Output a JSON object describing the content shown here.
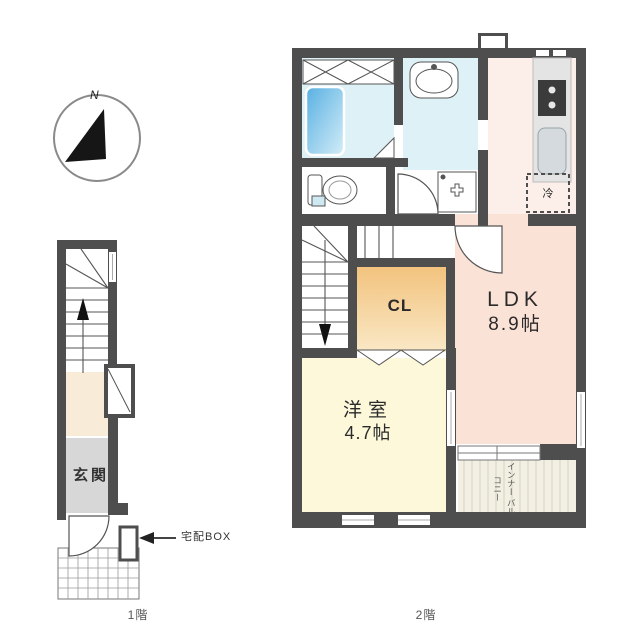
{
  "image": {
    "kind": "apartment-floor-plan",
    "background": "#ffffff"
  },
  "compass": {
    "north": "N"
  },
  "floor1": {
    "caption": "1階",
    "entrance": "玄関",
    "delivery_box": "宅配BOX"
  },
  "floor2": {
    "caption": "2階",
    "ldk": {
      "name": "LDK",
      "size": "8.9帖"
    },
    "closet": "CL",
    "western_room": {
      "name": "洋室",
      "size": "4.7帖"
    },
    "refrigerator": "冷",
    "balcony": {
      "line1": "インナー",
      "line2": "バルコニー"
    }
  },
  "colors": {
    "wall": "#4e4e4e",
    "bath_floor": "#def1f6",
    "tub": "#5fb3e3",
    "kitchen_floor": "#fcefe9",
    "ldk_floor": "#fbe2d7",
    "closet_top": "#f2c37e",
    "closet_bottom": "#fae8c6",
    "western_floor": "#fdf8da",
    "entrance_floor": "#d7d7d7",
    "hall_floor": "#f8ecd9",
    "balcony_floor": "#f2efe3"
  }
}
